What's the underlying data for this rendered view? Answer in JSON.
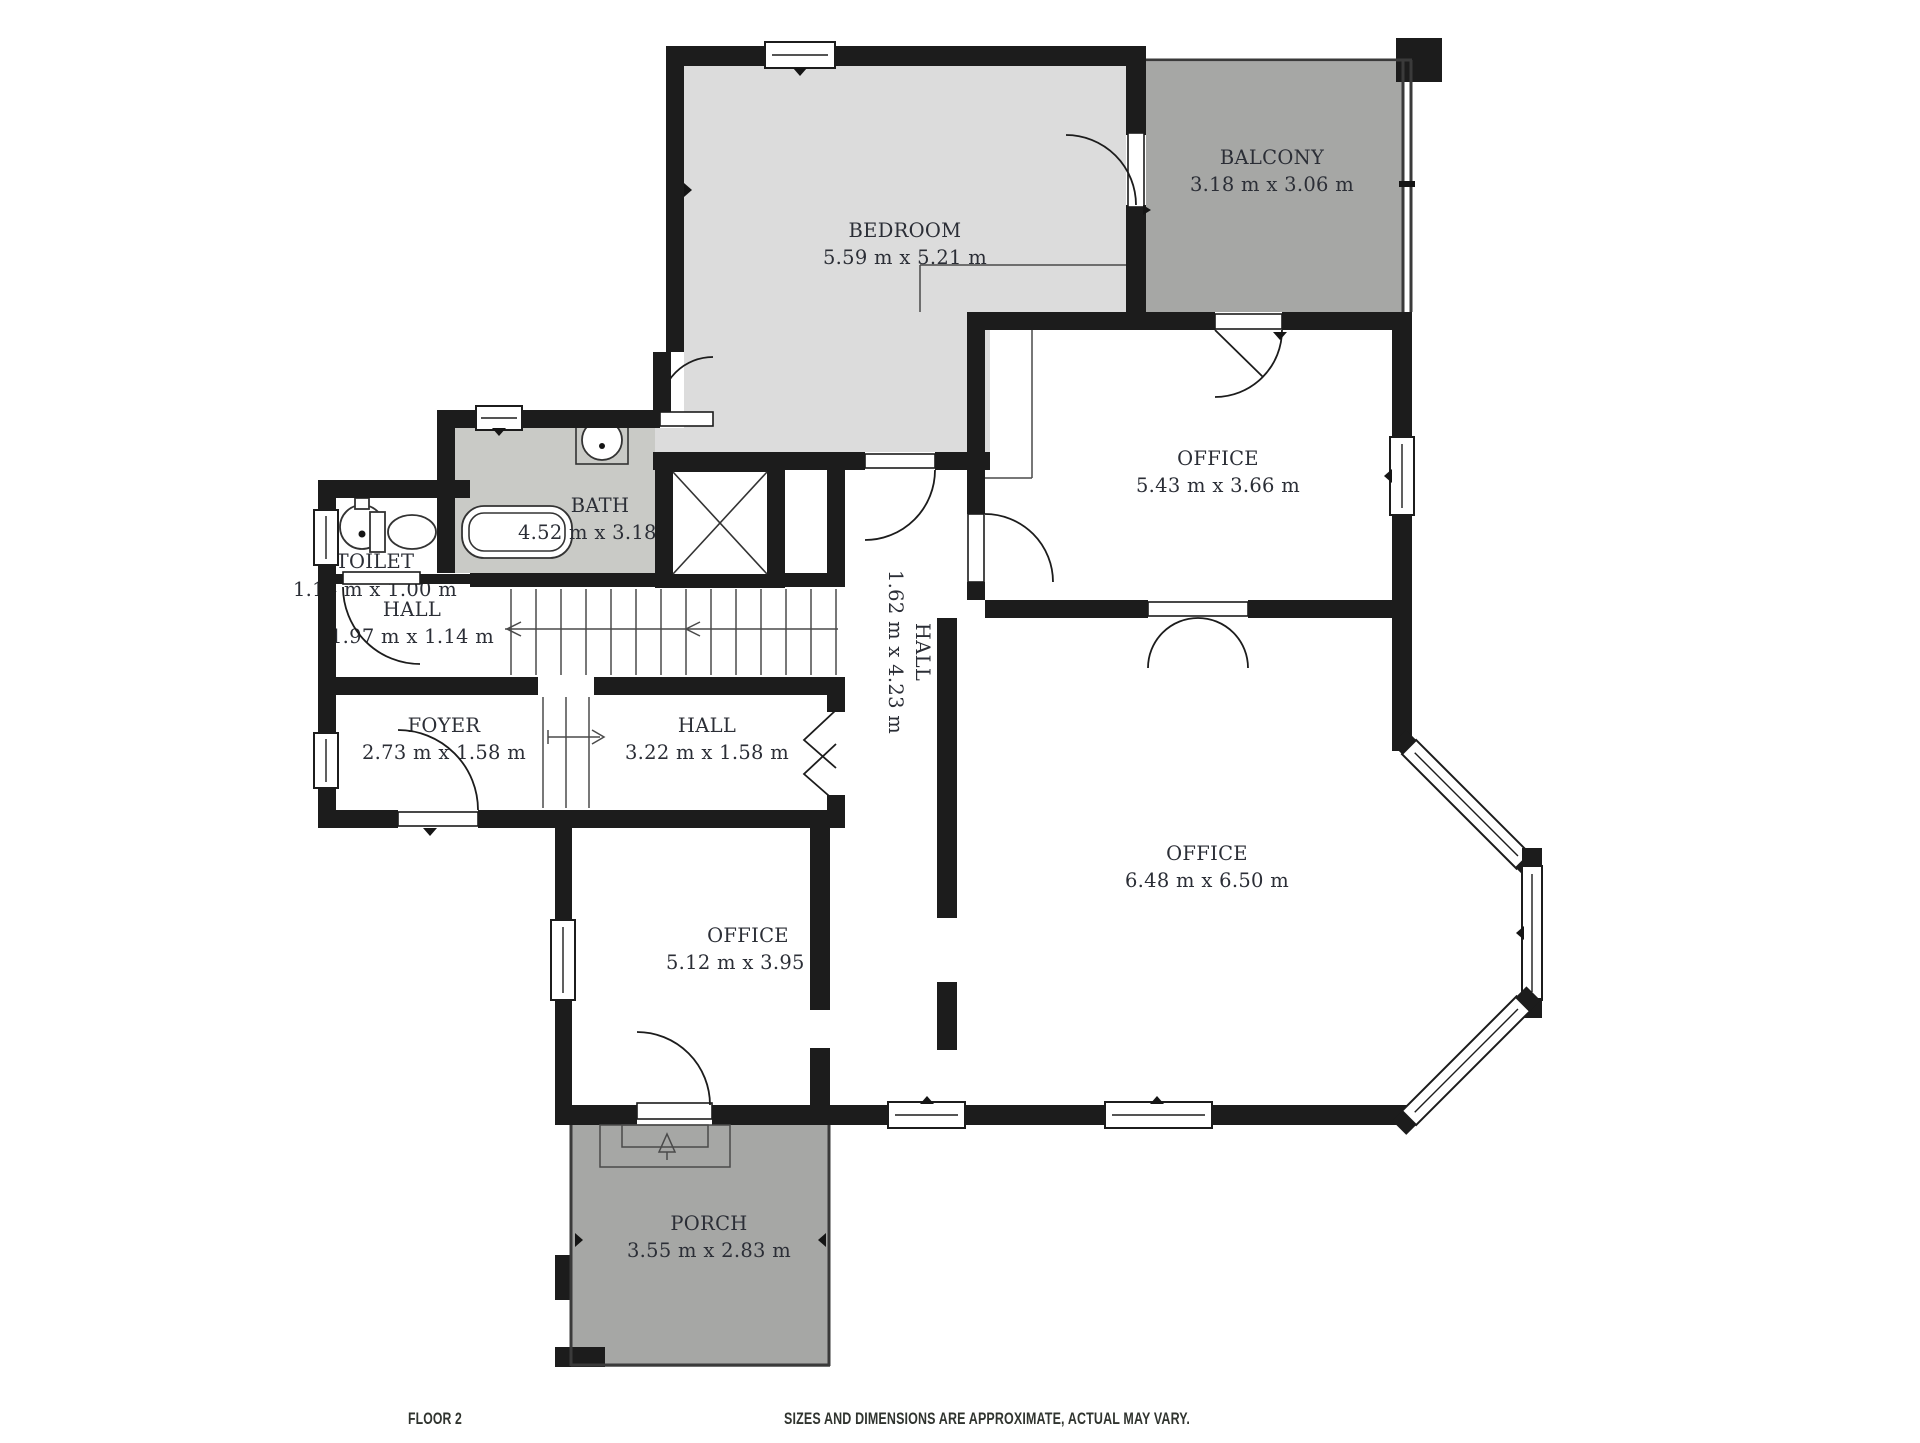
{
  "floor_plan": {
    "rooms": [
      {
        "name": "BEDROOM",
        "dims": "5.59 m x 5.21 m"
      },
      {
        "name": "BALCONY",
        "dims": "3.18 m x 3.06 m"
      },
      {
        "name": "OFFICE",
        "dims": "5.43 m x 3.66 m"
      },
      {
        "name": "BATH",
        "dims": "4.52 m x 3.18 m"
      },
      {
        "name": "TOILET",
        "dims": "1.14 m x 1.00 m"
      },
      {
        "name": "HALL",
        "dims": "1.97 m x 1.14 m"
      },
      {
        "name": "HALL",
        "dims": "1.62 m x 4.23 m"
      },
      {
        "name": "FOYER",
        "dims": "2.73 m x 1.58 m"
      },
      {
        "name": "HALL",
        "dims": "3.22 m x 1.58 m"
      },
      {
        "name": "OFFICE",
        "dims": "5.12 m x 3.95 m"
      },
      {
        "name": "OFFICE",
        "dims": "6.48 m x 6.50 m"
      },
      {
        "name": "PORCH",
        "dims": "3.55 m x 2.83 m"
      }
    ],
    "footer": {
      "floor_label": "FLOOR 2",
      "disclaimer": "SIZES AND DIMENSIONS ARE APPROXIMATE, ACTUAL MAY VARY."
    },
    "colors": {
      "wall": "#1c1c1c",
      "bedroom_fill": "#dcdcdc",
      "bath_fill": "#c9cac6",
      "balcony_fill": "#a6a7a5",
      "porch_fill": "#a6a7a5",
      "label_text": "#2b2e36",
      "footer_text": "#30342f",
      "background": "#ffffff"
    }
  }
}
